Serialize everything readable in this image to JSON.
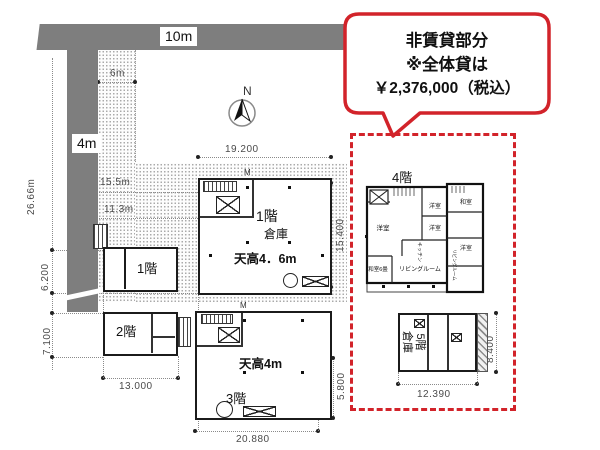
{
  "roads": {
    "top": "10m",
    "left": "4m",
    "setback": "6m"
  },
  "compass": {
    "north": "N"
  },
  "callout": {
    "line1": "非賃貸部分",
    "line2": "※全体貸は",
    "yen": "￥",
    "amount": "2,376,000",
    "tax": "（税込）"
  },
  "dims": {
    "total_left": "26.66m",
    "d6200": "6.200",
    "d7100": "7.100",
    "d15_5m": "15.5m",
    "d11_3m": "11.3m",
    "d19200": "19.200",
    "d15400": "15.400",
    "d13000": "13.000",
    "d20880": "20.880",
    "d5800": "5.800",
    "d12390": "12.390",
    "d8400": "8.400"
  },
  "floors": {
    "f1_annex": "1階",
    "f1": "1階",
    "f1_use": "倉庫",
    "f1_ceiling": "天高4．6m",
    "f2": "2階",
    "f3": "3階",
    "f3_ceiling": "天高4m",
    "f4": "4階",
    "f5": "5階",
    "f5_use": "倉庫"
  },
  "rooms4f": {
    "bed_left": "洋室",
    "bed_top": "洋室",
    "bed_mid": "洋室",
    "kitchen": "キッチン",
    "tatami6": "和室6畳",
    "living": "リビングルーム",
    "tatami_r": "和室",
    "bed_r": "洋室",
    "living_r": "リビングルーム"
  },
  "misc": {
    "m_mark": "M"
  }
}
